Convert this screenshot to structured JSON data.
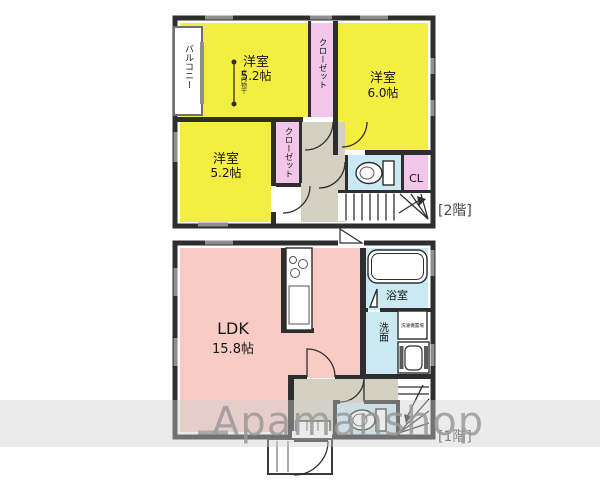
{
  "floor2": {
    "label": "[2階]",
    "balcony": "バルコニー",
    "indoor_drying": "室内物干",
    "room_nw": {
      "name": "洋室",
      "size": "5.2帖"
    },
    "closet_nw": "クローゼット",
    "room_ne": {
      "name": "洋室",
      "size": "6.0帖"
    },
    "room_sw": {
      "name": "洋室",
      "size": "5.2帖"
    },
    "closet_sw": "クローゼット",
    "cl": "CL"
  },
  "floor1": {
    "label": "[1階]",
    "ldk": {
      "name": "LDK",
      "size": "15.8帖"
    },
    "bath": "浴室",
    "washroom": "洗面",
    "laundry": "洗濯機置場"
  },
  "watermark": "Apamanshop",
  "colors": {
    "room_yellow": "#F5EE42",
    "ldk_pink": "#F8CBC5",
    "closet_pink": "#F2C6E8",
    "wet_blue": "#CAE9F2",
    "hall_gray": "#D4D0C2",
    "wall": "#2E2E2E",
    "watermark_gray": "#9A9A9A"
  }
}
